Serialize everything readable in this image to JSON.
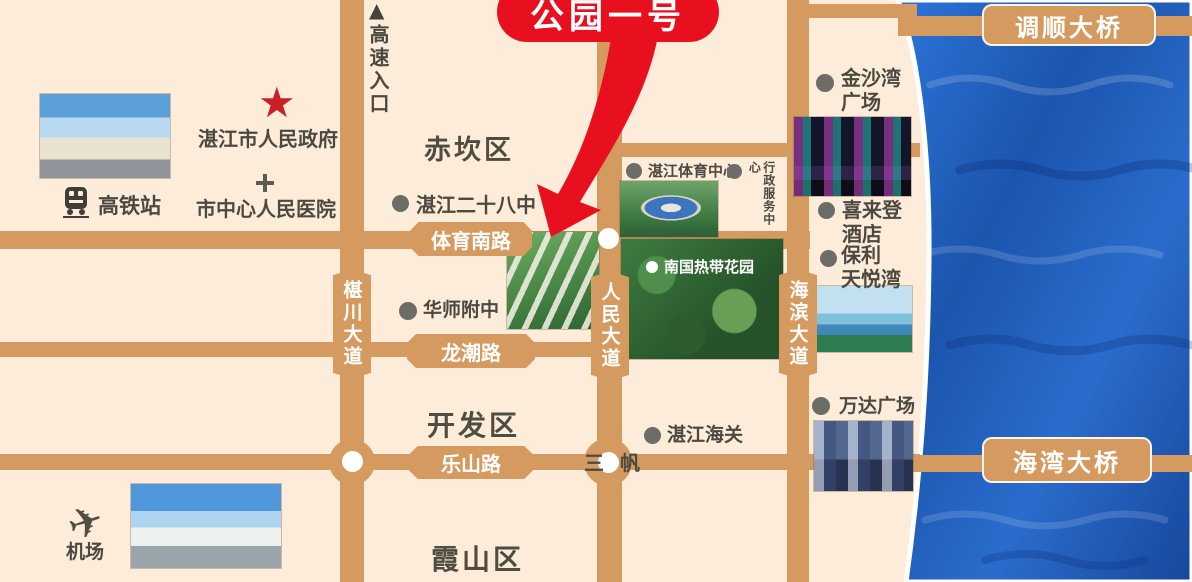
{
  "colors": {
    "land": "#fcecd9",
    "road": "#d59a5f",
    "sea": "#1e5fbe",
    "label_text": "#4c4a40",
    "road_label_text": "#ffffff",
    "accent_red": "#e8101f",
    "marker_gray": "#6d6d68",
    "star_red": "#cb2027"
  },
  "callout": {
    "label": "公园一号"
  },
  "districts": {
    "chikan": "赤坎区",
    "kaifaqu": "开发区",
    "xiashan": "霞山区"
  },
  "roads": {
    "tiyu_south": "体育南路",
    "longchao": "龙潮路",
    "leshan": "乐山路",
    "shenchuan_ave": "椹川大道",
    "renmin_ave": "人民大道",
    "haibin_ave": "海滨大道",
    "tiaoshun_bridge": "调顺大桥",
    "haiwan_bridge": "海湾大桥"
  },
  "pois": {
    "highway_entrance": "高速入口",
    "gov": "湛江市人民政府",
    "hospital": "市中心人民医院",
    "railway_station": "高铁站",
    "school_28": "湛江二十八中",
    "sports_center": "湛江体育中心",
    "admin_center": "行政服务中心",
    "tropical_garden": "南国热带花园",
    "jinshawan_plaza": "金沙湾\n广场",
    "sheraton_hotel": "喜来登\n酒店",
    "poly_tianyuewan": "保利\n天悦湾",
    "wanda_plaza": "万达广场",
    "customs": "湛江海关",
    "huashi_school": "华师附中",
    "sanfan": "三帆",
    "airport": "机场"
  },
  "glyphs": {
    "star": "★",
    "triangle_up": "▲",
    "plane": "✈"
  }
}
